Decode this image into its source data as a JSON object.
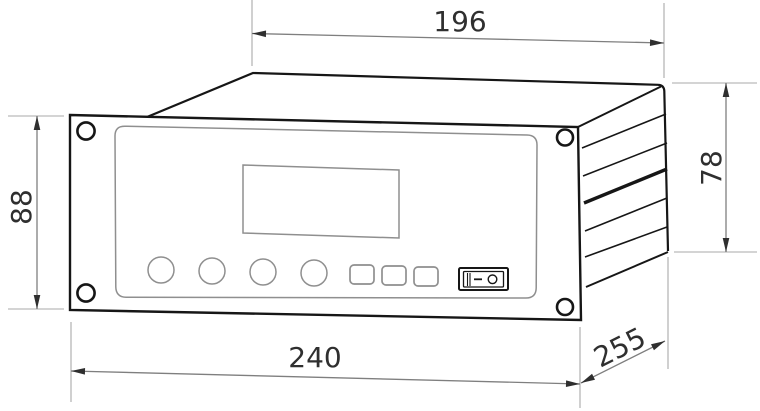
{
  "drawing": {
    "type": "technical-dimension-drawing",
    "subject": "panel-mount measuring instrument, oblique 3D view",
    "background": "#ffffff",
    "dimensions": {
      "top_width": "196",
      "left_height": "88",
      "right_height": "78",
      "bottom_width": "240",
      "depth": "255"
    },
    "colors": {
      "outline": "#161616",
      "detail_line": "#8f8f8f",
      "dimension_line": "#7f7f7f",
      "extension_line": "#a8a8a8",
      "arrow": "#2f2f2f",
      "text": "#2f2f2f"
    },
    "device": {
      "front_panel": {
        "corner_screws": 4,
        "round_buttons": 4,
        "square_buttons": 3,
        "display": "blank rectangular LCD window"
      },
      "power_switch": {
        "on_symbol": "−",
        "off_symbol": "○"
      },
      "side_face_louvers": 5
    }
  }
}
